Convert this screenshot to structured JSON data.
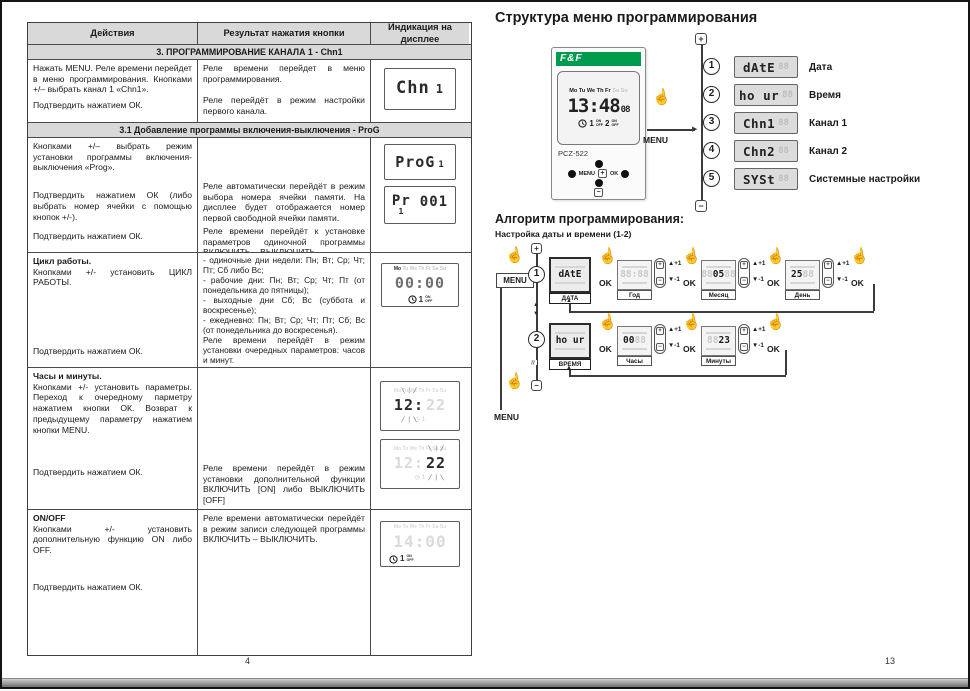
{
  "page": {
    "left_number": "4",
    "right_number": "13"
  },
  "icons": {
    "hand": "☝",
    "plus": "+",
    "minus": "−",
    "arrow_up": "▲",
    "arrow_down": "▼",
    "arrow_right": "▶"
  },
  "table": {
    "headers": [
      "Действия",
      "Результат нажатия кнопки",
      "Индикация на дисплее"
    ],
    "section_3": "3. ПРОГРАММИРОВАНИЕ КАНАЛА 1 - Chn1",
    "section_3_1": "3.1 Добавление программы включения-выключения - ProG",
    "row1": {
      "action1": "Нажать MENU. Реле времени перейдет в меню программирования. Кнопками +/– выбрать канал 1 «Chn1».",
      "action2": "Подтвердить нажатием ОК.",
      "result1": "Реле времени перейдет в меню программирования.",
      "result2": "Реле перейдёт в режим настройки первого канала.",
      "lcd_main": "Chn",
      "lcd_small": "1"
    },
    "row2": {
      "action1": "Кнопками +/– выбрать режим установки программы включения-выключения «Prog».",
      "action2": "Подтвердить нажатием ОК (либо выбрать номер ячейки с помощью кнопок +/-).",
      "action3": "Подтвердить нажатием ОК.",
      "result1": "Реле автоматически перейдёт в режим выбора номера ячейки памяти. На дисплее будет отображается номер первой свободной ячейки памяти.",
      "result2": "Реле времени перейдёт к установке параметров одиночной программы ВКЛЮЧИТЬ – ВЫКЛЮЧИТЬ",
      "lcd1_main": "ProG",
      "lcd1_small": "1",
      "lcd2_main": "Pr",
      "lcd2_sub": "1",
      "lcd2_num": "001"
    },
    "row3": {
      "title": "Цикл работы.",
      "action1": "Кнопками +/- установить ЦИКЛ РАБОТЫ.",
      "action2": "Подтвердить нажатием ОК.",
      "result_lines": [
        "- одиночные дни недели: Пн; Вт; Ср; Чт; Пт; Сб либо Вс;",
        "- рабочие дни: Пн; Вт; Ср; Чт; Пт (от понедельника до пятницы);",
        "- выходные дни Сб; Вс (суббота и воскресенье);",
        "- ежедневно: Пн; Вт; Ср; Чт; Пт; Сб; Вс (от понедельника до воскресенья)."
      ],
      "result2": "Реле времени перейдёт в режим установки очередных параметров: часов и минут.",
      "lcd_week_active": "Mo",
      "lcd_week_ghost": "Tu We Th Fr Sa Su",
      "lcd_time": "00:00",
      "lcd_ch": "1",
      "lcd_on": "ON",
      "lcd_off": "OFF"
    },
    "row4": {
      "title": "Часы и минуты.",
      "action1": "Кнопками +/- установить параметры. Переход к очередному парметру нажатием кнопки ОК. Возврат к предыдущему параметру нажатием кнопки MENU.",
      "action2": "Подтвердить нажатием ОК.",
      "result1": "Реле времени перейдёт в режим установки дополнительной функции ВКЛЮЧИТЬ [ON] либо ВЫКЛЮЧИТЬ [OFF]",
      "lcd1_blink": "12:",
      "lcd1_ghost": "22",
      "lcd2_ghost": "12:",
      "lcd2_blink": "22"
    },
    "row5": {
      "title": "ON/OFF",
      "action1": "Кнопками +/- установить дополнительную функцию ON либо OFF.",
      "action2": "Подтвердить нажатием ОК.",
      "result1": "Реле времени автоматически перейдёт в режим записи следующей программы ВКЛЮЧИТЬ – ВЫКЛЮЧИТЬ.",
      "lcd_time": "14:00",
      "lcd_ch": "1",
      "lcd_on": "ON",
      "lcd_off": "OFF"
    }
  },
  "menu_structure": {
    "title": "Структура меню программирования",
    "device": {
      "brand": "F&F",
      "model": "PCZ-522",
      "week_active": "Mo Tu We Th Fr",
      "week_ghost": "Sa Su",
      "time": "13:48",
      "seconds": "08",
      "ch1": "1",
      "ch2": "2",
      "on": "ON",
      "off": "OFF",
      "btn_menu": "MENU",
      "btn_ok": "OK"
    },
    "menu_button_label": "MENU",
    "items": [
      {
        "num": "1",
        "code": "dAtE",
        "ghost": "88",
        "label": "Дата"
      },
      {
        "num": "2",
        "code": "ho ur",
        "ghost": "88",
        "label": "Время"
      },
      {
        "num": "3",
        "code": "Chn1",
        "ghost": "88",
        "label": "Канал 1"
      },
      {
        "num": "4",
        "code": "Chn2",
        "ghost": "88",
        "label": "Канал 2"
      },
      {
        "num": "5",
        "code": "SYSt",
        "ghost": "88",
        "label": "Системные настройки"
      }
    ]
  },
  "algorithm": {
    "title": "Алгоритм программирования:",
    "subtitle": "Настройка даты и времени (1-2)",
    "menu_label": "MENU",
    "ok_label": "OK",
    "plus_one": "+1",
    "minus_one": "-1",
    "row1": {
      "num": "1",
      "code": "dAtE",
      "name": "ДАТА",
      "steps": [
        {
          "ghost_left": "88:88",
          "value": "",
          "ghost_right": "",
          "label": "Год"
        },
        {
          "ghost_left": "88",
          "value": "05",
          "ghost_right": "88",
          "label": "Месяц"
        },
        {
          "ghost_left": "",
          "value": "25",
          "ghost_right": "88",
          "label": "День"
        }
      ]
    },
    "row2": {
      "num": "2",
      "code": "ho ur",
      "name": "ВРЕМЯ",
      "steps": [
        {
          "ghost_left": "",
          "value": "00",
          "ghost_right": "88",
          "label": "Часы"
        },
        {
          "ghost_left": "88",
          "value": "23",
          "ghost_right": "",
          "label": "Минуты"
        }
      ]
    }
  }
}
